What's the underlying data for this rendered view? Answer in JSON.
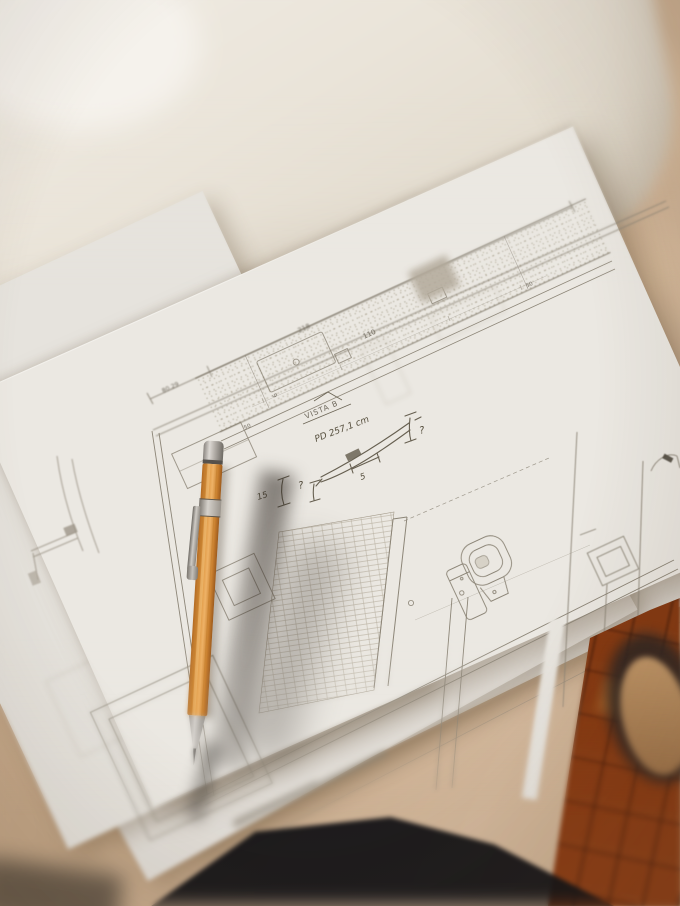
{
  "blueprint": {
    "view_label": "VISTA B",
    "depth_note": "PD 257,1 cm",
    "dimensions": {
      "overall": "218",
      "left_segment": "80.29",
      "counter_length": "110",
      "counter_depth": "9",
      "left_end": "50",
      "right_end": "50"
    },
    "annotations": {
      "height_mark": "15",
      "query_left": "?",
      "gap": "5",
      "query_right": "?"
    }
  },
  "colors": {
    "pencil_barrel": "#d8943e",
    "paper": "#eae7e1",
    "table_surface": "#c8ab8d",
    "wood_floor": "#8a3c14",
    "ink_line": "#8c8577"
  }
}
